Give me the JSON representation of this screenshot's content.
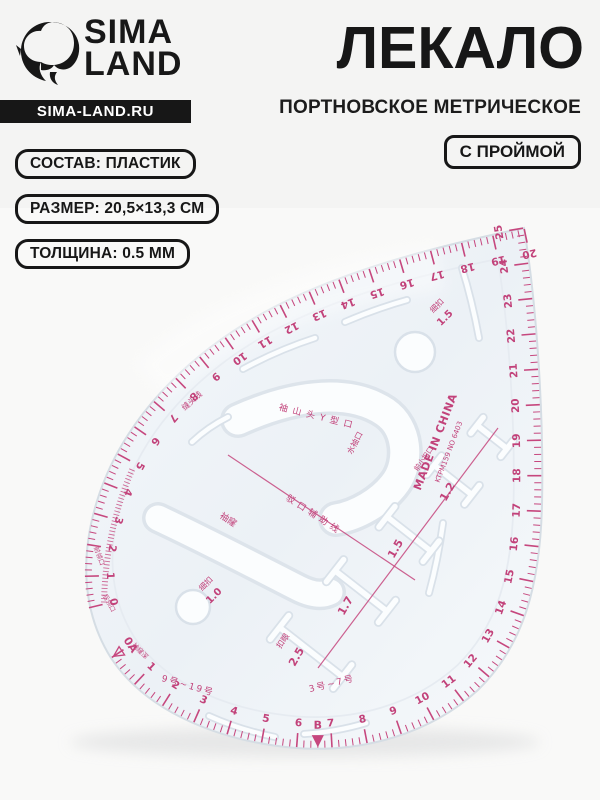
{
  "header": {
    "brand": {
      "line1": "SIMA",
      "line2": "LAND",
      "url_badge": "SIMA-LAND.RU"
    },
    "title": "ЛЕКАЛО",
    "subtitle": "ПОРТНОВСКОЕ МЕТРИЧЕСКОЕ",
    "feature_badge": "С ПРОЙМОЙ"
  },
  "spec_badges": [
    {
      "label": "СОСТАВ: ПЛАСТИК"
    },
    {
      "label": "РАЗМЕР: 20,5×13,3 СМ"
    },
    {
      "label": "ТОЛЩИНА: 0.5 ММ"
    }
  ],
  "ruler": {
    "colors": {
      "tick": "#c6477e",
      "number": "#c2427a",
      "body_stroke": "#d5dde4",
      "cut_stroke": "#d9e1e9",
      "cut_fill": "#fbfdfe",
      "black": "#171717"
    },
    "scales": [
      {
        "path": "edge-top",
        "from": 20,
        "to": 0,
        "minor_per_unit": 5,
        "label_offset": 26
      },
      {
        "path": "edge-bottom",
        "from": 0,
        "to": 25,
        "minor_per_unit": 5,
        "label_offset": 25,
        "skip_zero_label": true
      },
      {
        "path": "vernier-left",
        "from": 0,
        "to": 8,
        "minor_per_unit": 5,
        "ticks_only": true
      }
    ],
    "markers": [
      {
        "path": "edge-bottom",
        "unit": 0,
        "text": "0A",
        "filled": false
      },
      {
        "path": "edge-bottom",
        "unit": 6.6,
        "text": "B",
        "filled": true
      }
    ],
    "labels": [
      {
        "text": "MADE IN CHINA",
        "x": 436,
        "y": 442,
        "rot": -69,
        "size": 11,
        "weight": "bold",
        "ls": 0.5
      },
      {
        "text": "KTPM159  NO 6403",
        "x": 449,
        "y": 452,
        "rot": -69,
        "size": 7,
        "weight": "normal"
      },
      {
        "text": "袖山头Y型口",
        "x": 318,
        "y": 417,
        "rot": 14,
        "size": 9,
        "ls": 5
      },
      {
        "text": "水袖口",
        "x": 355,
        "y": 443,
        "rot": -62,
        "size": 8
      },
      {
        "text": "缝头线",
        "x": 192,
        "y": 401,
        "rot": -42,
        "size": 8
      },
      {
        "text": "驳口辅助线",
        "x": 314,
        "y": 515,
        "rot": 33,
        "size": 9,
        "ls": 4
      },
      {
        "text": "袖窿",
        "x": 228,
        "y": 520,
        "rot": 33,
        "size": 9
      },
      {
        "text": "细扣",
        "x": 437,
        "y": 306,
        "rot": -45,
        "size": 8
      },
      {
        "text": "1.5",
        "x": 445,
        "y": 318,
        "rot": -45,
        "size": 10,
        "weight": "bold"
      },
      {
        "text": "细扣",
        "x": 206,
        "y": 584,
        "rot": -45,
        "size": 8
      },
      {
        "text": "1.0",
        "x": 214,
        "y": 596,
        "rot": -45,
        "size": 10,
        "weight": "bold"
      },
      {
        "text": "扣眼",
        "x": 283,
        "y": 641,
        "rot": -55,
        "size": 8
      },
      {
        "text": "2.5",
        "x": 297,
        "y": 657,
        "rot": -60,
        "size": 11,
        "weight": "bold"
      },
      {
        "text": "1.7",
        "x": 346,
        "y": 606,
        "rot": -60,
        "size": 11,
        "weight": "bold"
      },
      {
        "text": "1.5",
        "x": 396,
        "y": 549,
        "rot": -60,
        "size": 11,
        "weight": "bold"
      },
      {
        "text": "1.2",
        "x": 448,
        "y": 492,
        "rot": -60,
        "size": 11,
        "weight": "bold"
      },
      {
        "text": "前小扣口",
        "x": 424,
        "y": 459,
        "rot": -55,
        "size": 7
      },
      {
        "text": "9号~19号",
        "x": 188,
        "y": 686,
        "rot": 16,
        "size": 9,
        "ls": 2
      },
      {
        "text": "3号~7号",
        "x": 332,
        "y": 684,
        "rot": -14,
        "size": 9,
        "ls": 2
      },
      {
        "text": "前领口",
        "x": 99,
        "y": 556,
        "rot": 70,
        "size": 6.5
      },
      {
        "text": "后领口",
        "x": 109,
        "y": 603,
        "rot": 62,
        "size": 6.5
      },
      {
        "text": "袖窿深",
        "x": 140,
        "y": 651,
        "rot": 45,
        "size": 6.5
      }
    ],
    "guide_lines": [
      {
        "x1": 228,
        "y1": 455,
        "x2": 415,
        "y2": 580
      },
      {
        "x1": 318,
        "y1": 668,
        "x2": 498,
        "y2": 428
      }
    ],
    "buttonhole_slots": [
      {
        "x": 311,
        "y": 652,
        "len": 80,
        "rot": 38,
        "cross": 30
      },
      {
        "x": 361,
        "y": 591,
        "len": 66,
        "rot": 38,
        "cross": 28
      },
      {
        "x": 409,
        "y": 534,
        "len": 56,
        "rot": 38,
        "cross": 26
      },
      {
        "x": 453,
        "y": 480,
        "len": 48,
        "rot": 38,
        "cross": 24
      },
      {
        "x": 492,
        "y": 437,
        "len": 38,
        "rot": 38,
        "cross": 20
      }
    ],
    "holes": [
      {
        "x": 415,
        "y": 352,
        "r": 20
      },
      {
        "x": 193,
        "y": 607,
        "r": 17
      }
    ],
    "thin_slots": [
      {
        "d": "M192,442 Q208,427 228,417"
      },
      {
        "d": "M243,369 Q278,350 315,338"
      },
      {
        "d": "M345,322 Q375,309 407,300"
      },
      {
        "d": "M462,268 Q472,300 479,338"
      },
      {
        "d": "M443,523 Q438,560 429,593"
      },
      {
        "d": "M209,716 Q240,730 275,737"
      },
      {
        "d": "M304,734 Q336,732 366,723"
      }
    ]
  }
}
